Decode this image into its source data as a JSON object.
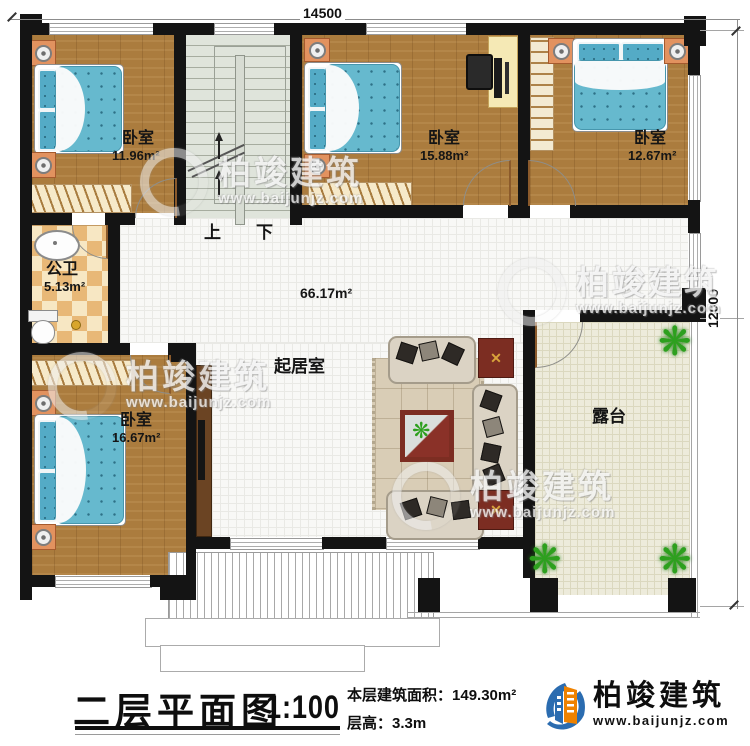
{
  "dimensions": {
    "top": "14500",
    "right": "12000"
  },
  "rooms": {
    "bedroom_nw": {
      "label": "卧室",
      "area": "11.96m²"
    },
    "bedroom_n": {
      "label": "卧室",
      "area": "15.88m²"
    },
    "bedroom_ne": {
      "label": "卧室",
      "area": "12.67m²"
    },
    "bathroom": {
      "label": "公卫",
      "area": "5.13m²"
    },
    "living": {
      "label": "起居室",
      "area": "66.17m²"
    },
    "bedroom_sw": {
      "label": "卧室",
      "area": "16.67m²"
    },
    "terrace": {
      "label": "露台"
    }
  },
  "stairs": {
    "up": "上",
    "down": "下"
  },
  "titleblock": {
    "title": "二层平面图",
    "scale": "1:100",
    "area_label": "本层建筑面积：",
    "area_value": "149.30m²",
    "floor_height_label": "层高：",
    "floor_height_value": "3.3m"
  },
  "brand": {
    "name": "柏竣建筑",
    "url": "www.baijunjz.com"
  },
  "watermark": {
    "name": "柏竣建筑",
    "url": "www.baijunjz.com"
  },
  "icons": {
    "plant": "❋",
    "gold_cross": "✕"
  },
  "colors": {
    "wall": "#141414",
    "wood": "#ab7c3e",
    "mattress": "#66b9ce",
    "stair": "#dfe4db",
    "terrace": "#edebdb",
    "accent_red": "#7c2d22",
    "brand_blue": "#2b6cb0",
    "brand_orange": "#ef8200"
  }
}
